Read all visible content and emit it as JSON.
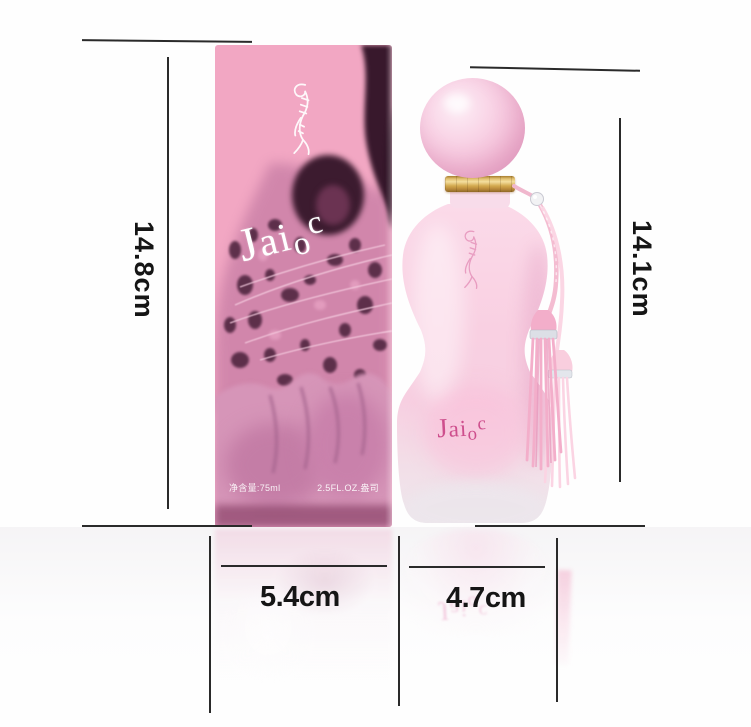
{
  "annotations": {
    "box_height_label": "14.8cm",
    "bottle_height_label": "14.1cm",
    "box_width_label": "5.4cm",
    "bottle_width_label": "4.7cm"
  },
  "product": {
    "brand": "Jaioc",
    "brand_letters": [
      "J",
      "a",
      "i",
      "o",
      "c"
    ],
    "box_text_left": "净含量:75ml",
    "box_text_right": "2.5FL.OZ.盎司"
  },
  "icons": {
    "box_logo": "tiger-logo",
    "bottle_logo": "tiger-logo"
  },
  "colors": {
    "box_pink": "#f2a7c3",
    "leopard_dark": "#3c1b2f",
    "bottle_body_pink": "#f8cfe2",
    "gold_band": "#d8ab52",
    "brand_text_pink": "#ce4f8d",
    "tassel_pink": "#f3aeca",
    "annotation_line": "#2a2a2a"
  }
}
